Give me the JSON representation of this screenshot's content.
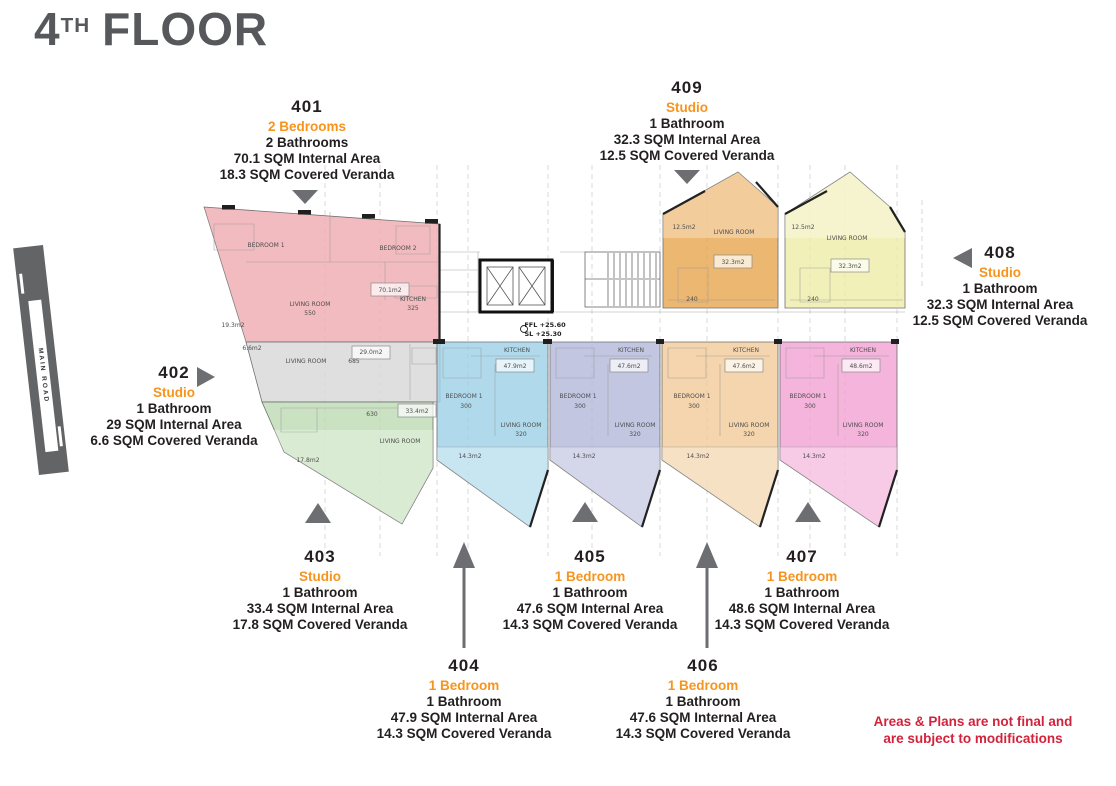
{
  "title": {
    "number": "4",
    "ordinal": "TH",
    "word": "FLOOR"
  },
  "road_label": "MAIN ROAD",
  "disclaimer": [
    "Areas & Plans are not final and",
    "are subject to modifications"
  ],
  "colors": {
    "accent": "#f7941d",
    "ink": "#231f20",
    "title": "#57585b",
    "arrow": "#6d6e71",
    "red": "#d2233c",
    "road": "#636466"
  },
  "units": [
    {
      "number": "401",
      "type": "2 Bedrooms",
      "bathrooms": "2 Bathrooms",
      "internal_area": "70.1 SQM Internal Area",
      "covered_veranda": "18.3 SQM Covered Veranda",
      "color": "#efacb2"
    },
    {
      "number": "402",
      "type": "Studio",
      "bathrooms": "1 Bathroom",
      "internal_area": "29 SQM Internal Area",
      "covered_veranda": "6.6 SQM Covered Veranda",
      "color": "#d8d8d8"
    },
    {
      "number": "403",
      "type": "Studio",
      "bathrooms": "1 Bathroom",
      "internal_area": "33.4 SQM Internal Area",
      "covered_veranda": "17.8 SQM Covered Veranda",
      "color": "#bedcb4"
    },
    {
      "number": "404",
      "type": "1 Bedroom",
      "bathrooms": "1 Bathroom",
      "internal_area": "47.9 SQM Internal Area",
      "covered_veranda": "14.3 SQM Covered Veranda",
      "color": "#9fd2e8"
    },
    {
      "number": "405",
      "type": "1 Bedroom",
      "bathrooms": "1 Bathroom",
      "internal_area": "47.6 SQM Internal Area",
      "covered_veranda": "14.3 SQM Covered Veranda",
      "color": "#b5badb"
    },
    {
      "number": "406",
      "type": "1 Bedroom",
      "bathrooms": "1 Bathroom",
      "internal_area": "47.6 SQM Internal Area",
      "covered_veranda": "14.3 SQM Covered Veranda",
      "color": "#f1cc9b"
    },
    {
      "number": "407",
      "type": "1 Bedroom",
      "bathrooms": "1 Bathroom",
      "internal_area": "48.6 SQM Internal Area",
      "covered_veranda": "14.3 SQM Covered Veranda",
      "color": "#f1a3d3"
    },
    {
      "number": "408",
      "type": "Studio",
      "bathrooms": "1 Bathroom",
      "internal_area": "32.3 SQM Internal Area",
      "covered_veranda": "12.5 SQM Covered Veranda",
      "color": "#efedaa"
    },
    {
      "number": "409",
      "type": "Studio",
      "bathrooms": "1 Bathroom",
      "internal_area": "32.3 SQM Internal Area",
      "covered_veranda": "12.5 SQM Covered Veranda",
      "color": "#e8a751"
    }
  ],
  "plan": {
    "labels": [
      "BEDROOM 1",
      "BEDROOM 2",
      "LIVING ROOM",
      "550",
      "KITCHEN",
      "325",
      "70.1m2",
      "19.3m2",
      "6.6m2",
      "LIVING ROOM",
      "685",
      "29.0m2",
      "33.4m2",
      "LIVING ROOM",
      "630",
      "17.8m2",
      "KITCHEN",
      "47.9m2",
      "BEDROOM 1",
      "300",
      "LIVING ROOM",
      "320",
      "14.3m2",
      "KITCHEN",
      "47.6m2",
      "BEDROOM 1",
      "300",
      "LIVING ROOM",
      "320",
      "14.3m2",
      "KITCHEN",
      "47.6m2",
      "BEDROOM 1",
      "300",
      "LIVING ROOM",
      "320",
      "14.3m2",
      "KITCHEN",
      "48.6m2",
      "BEDROOM 1",
      "300",
      "LIVING ROOM",
      "320",
      "14.3m2",
      "12.5m2",
      "LIVING ROOM",
      "32.3m2",
      "240",
      "12.5m2",
      "LIVING ROOM",
      "32.3m2",
      "240",
      "FFL +25.60",
      "SL +25.30"
    ]
  }
}
